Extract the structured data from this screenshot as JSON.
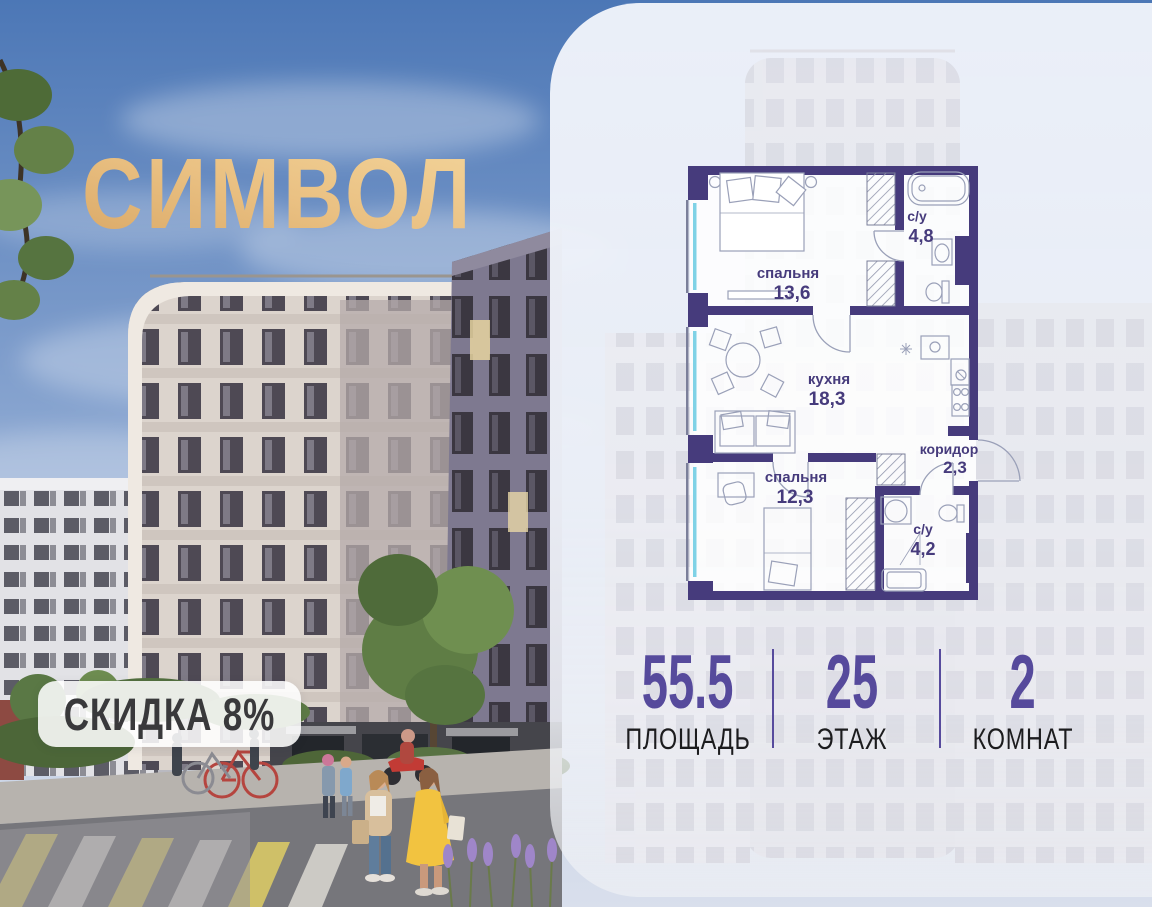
{
  "brand": {
    "name": "СИМВОЛ"
  },
  "badge": {
    "text": "СКИДКА 8%"
  },
  "floorplan": {
    "rooms": [
      {
        "name": "спальня",
        "area": "13,6"
      },
      {
        "name": "с/у",
        "area": "4,8"
      },
      {
        "name": "кухня",
        "area": "18,3"
      },
      {
        "name": "коридор",
        "area": "2,3"
      },
      {
        "name": "спальня",
        "area": "12,3"
      },
      {
        "name": "с/у",
        "area": "4,2"
      }
    ]
  },
  "stats": [
    {
      "value": "55.5",
      "label": "ПЛОЩАДЬ"
    },
    {
      "value": "25",
      "label": "ЭТАЖ"
    },
    {
      "value": "2",
      "label": "КОМНАТ"
    }
  ],
  "colors": {
    "accent_purple": "#564a9c",
    "wall_purple": "#463b7c",
    "gold": "#e8bc80",
    "panel_bg": "#eef1f8",
    "window_glass": "#7fd2e6"
  }
}
